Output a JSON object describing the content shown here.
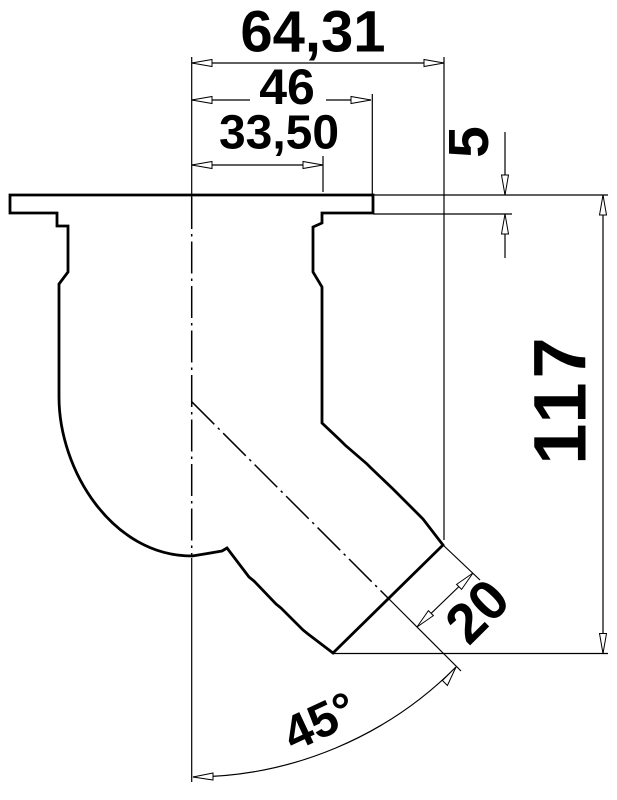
{
  "drawing": {
    "type": "technical-dimension-drawing",
    "subject": "45-degree flanged outlet pipe fitting, side profile with ribbed hose spout",
    "background_color": "#ffffff",
    "line_color": "#000000",
    "dimensions": {
      "overall_width": {
        "label": "64,31",
        "orientation": "horizontal"
      },
      "flange_half_width": {
        "label": "46",
        "orientation": "horizontal"
      },
      "neck_half_width": {
        "label": "33,50",
        "orientation": "horizontal"
      },
      "flange_thickness": {
        "label": "5",
        "orientation": "vertical"
      },
      "overall_height": {
        "label": "117",
        "orientation": "vertical"
      },
      "spout_radius": {
        "label": "20",
        "orientation": "diagonal"
      },
      "spout_angle": {
        "label": "45°",
        "orientation": "angular"
      }
    }
  }
}
